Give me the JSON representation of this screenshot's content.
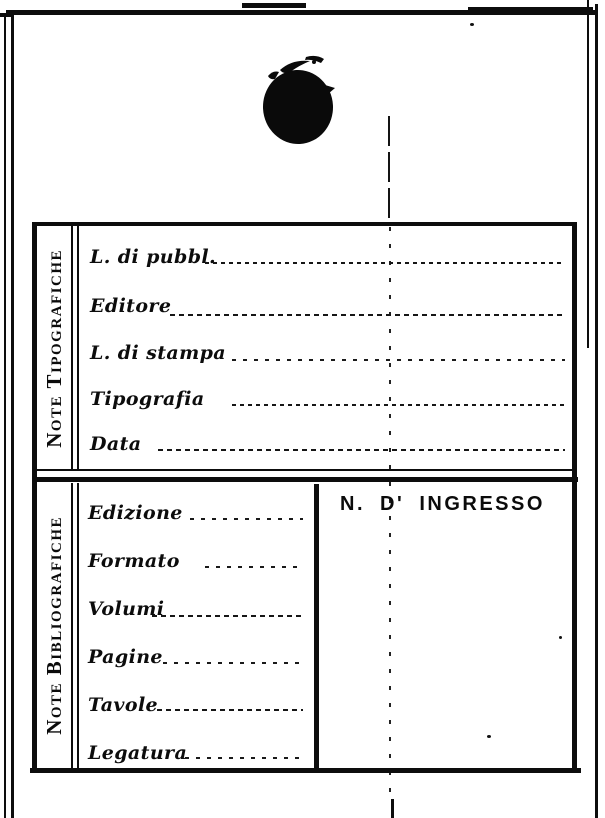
{
  "document": {
    "kind": "scanned library accession card",
    "paper_color": "#ffffff",
    "ink_color": "#0d0d0d"
  },
  "stamp": {
    "name": "ink-blot"
  },
  "sections": {
    "tipografiche": {
      "side_label": "Note Tipografiche",
      "fields": [
        {
          "label": "L. di pubbl.",
          "value": ""
        },
        {
          "label": "Editore",
          "value": ""
        },
        {
          "label": "L. di stampa",
          "value": ""
        },
        {
          "label": "Tipografia",
          "value": ""
        },
        {
          "label": "Data",
          "value": ""
        }
      ]
    },
    "bibliografiche": {
      "side_label": "Note Bibliografiche",
      "fields": [
        {
          "label": "Edizione",
          "value": ""
        },
        {
          "label": "Formato",
          "value": ""
        },
        {
          "label": "Volumi",
          "value": ""
        },
        {
          "label": "Pagine",
          "value": ""
        },
        {
          "label": "Tavole",
          "value": ""
        },
        {
          "label": "Legatura",
          "value": ""
        }
      ],
      "ingresso_heading": "N. D' INGRESSO",
      "ingresso_value": ""
    }
  }
}
